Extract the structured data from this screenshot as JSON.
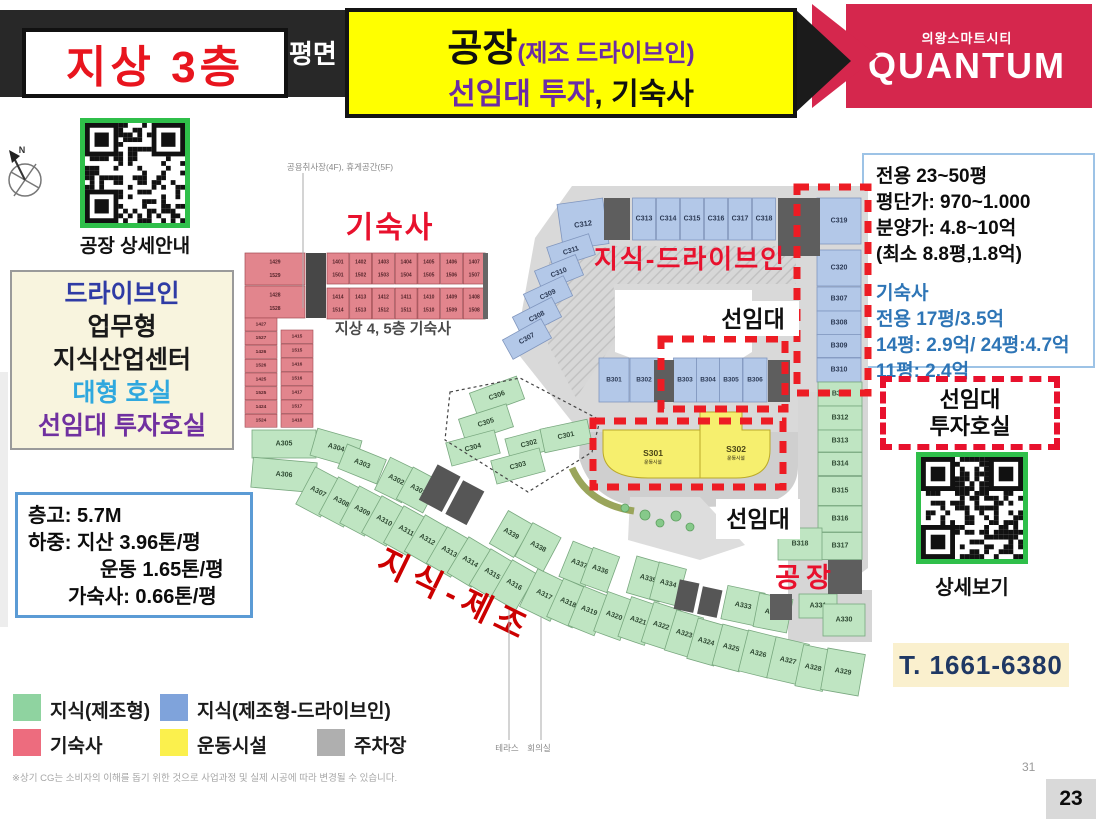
{
  "header": {
    "floor_badge": "지상 3층",
    "bar_partial_text": "평면",
    "banner_line1_main": "공장",
    "banner_line1_sub": "(제조 드라이브인)",
    "banner_line2_accent": "선임대 투자",
    "banner_line2_rest": ", 기숙사",
    "brand_city": "의왕스마트시티",
    "brand_name": "QUANTUM"
  },
  "qr_top": {
    "label": "공장 상세안내"
  },
  "feature_box": {
    "lines": [
      {
        "text": "드라이브인",
        "color": "#2F3BA5"
      },
      {
        "text": "업무형",
        "color": "#1A1A1A"
      },
      {
        "text": "지식산업센터",
        "color": "#1A1A1A"
      },
      {
        "text": "대형 호실",
        "color": "#2FA8DE"
      },
      {
        "text": "선임대 투자호실",
        "color": "#7030A0"
      }
    ]
  },
  "spec_box": {
    "lines": [
      "층고: 5.7M",
      "하중: 지산 3.96톤/평",
      "운동 1.65톤/평",
      "가숙사: 0.66톤/평"
    ]
  },
  "price_box": {
    "black_lines": [
      "전용 23~50평",
      "평단가: 970~1.000",
      "분양가: 4.8~10억",
      "(최소 8.8평,1.8억)"
    ],
    "blue_lines": [
      "기숙사",
      "전용 17평/3.5억",
      "14평: 2.9억/ 24평:4.7억",
      "11평: 2.4억"
    ]
  },
  "prelease_box": {
    "line1": "선임대",
    "line2": "투자호실",
    "qr_label": "상세보기"
  },
  "phone": "T. 1661-6380",
  "page": {
    "small": "31",
    "big": "23"
  },
  "legend": {
    "items": [
      {
        "label": "지식(제조형)",
        "color": "#8FD3A0"
      },
      {
        "label": "지식(제조형-드라이브인)",
        "color": "#7FA3DB"
      },
      {
        "label": "기숙사",
        "color": "#ED6C7E"
      },
      {
        "label": "운동시설",
        "color": "#FBF04D"
      },
      {
        "label": "주차장",
        "color": "#AFAFAF"
      }
    ]
  },
  "footnote": "※상기 CG는 소비자의 이해를 돕기 위한 것으로 사업과정 및 실제 시공에 따라 변경될 수 있습니다.",
  "plan": {
    "compass": "N",
    "callout_top": "공용취사장(4F), 휴게공간(5F)",
    "dorm_title": "기숙사",
    "dorm_caption": "지상 4, 5층 기숙사",
    "label_drive_in": "지식-드라이브인",
    "label_manufacture": "지식-제조",
    "label_factory": "공장",
    "label_prelease_1": "선임대",
    "label_prelease_2": "선임대",
    "label_terrace": "테라스",
    "label_meeting": "회의실",
    "colors": {
      "green": "#BFE5C2",
      "blue": "#B3C8E8",
      "pink": "#E2858D",
      "yellow": "#F6EF6E",
      "corridor": "#D9D9D9",
      "dash_red": "#ED1C24"
    },
    "rooms": {
      "blue_top": [
        "C313",
        "C314",
        "C315",
        "C316",
        "C317",
        "C318"
      ],
      "blue_corner": "C312",
      "blue_diag": [
        "C311",
        "C310",
        "C309",
        "C308",
        "C307"
      ],
      "blue_right": [
        "C319",
        "C320",
        "B307",
        "B308",
        "B309",
        "B310"
      ],
      "blue_center": [
        "B301",
        "B302",
        "B303",
        "B304",
        "B305",
        "B306"
      ],
      "green_cluster": [
        "C306",
        "C305",
        "C304",
        "C302",
        "C303",
        "C301"
      ],
      "green_right": [
        "B311",
        "B312",
        "B313",
        "B314",
        "B315",
        "B316",
        "B317"
      ],
      "green_right_extra": [
        "B319",
        "B318"
      ],
      "green_band_lower": [
        "A305",
        "A306",
        "A307",
        "A308",
        "A309",
        "A310",
        "A311",
        "A312",
        "A313",
        "A314",
        "A315",
        "A316",
        "A317",
        "A318",
        "A319",
        "A320",
        "A321",
        "A322",
        "A323",
        "A324",
        "A325",
        "A326",
        "A327",
        "A328",
        "A329"
      ],
      "green_band_upper": [
        "A304",
        "A303",
        "A302",
        "A301",
        "A339",
        "A338",
        "A337",
        "A336",
        "A335",
        "A334",
        "A333",
        "A332",
        "A331",
        "A330"
      ],
      "sports": [
        {
          "id": "S301",
          "sub": "운동시설"
        },
        {
          "id": "S302",
          "sub": "운동시설"
        }
      ],
      "dorm_row1_top": [
        "1401",
        "1402",
        "1403",
        "1404",
        "1405",
        "1406",
        "1407"
      ],
      "dorm_row1_bottom": [
        "1501",
        "1502",
        "1503",
        "1504",
        "1505",
        "1506",
        "1507"
      ],
      "dorm_row2_top": [
        "1414",
        "1413",
        "1412",
        "1411",
        "1410",
        "1409",
        "1408"
      ],
      "dorm_row2_bottom": [
        "1514",
        "1513",
        "1512",
        "1511",
        "1510",
        "1509",
        "1508"
      ],
      "dorm_corner": [
        [
          "1429",
          "1529"
        ],
        [
          "1428",
          "1528"
        ]
      ],
      "dorm_left_col": [
        "1427",
        "1527",
        "1426",
        "1526",
        "1425",
        "1525",
        "1424",
        "1524"
      ],
      "dorm_inner_col": [
        "1415",
        "1515",
        "1416",
        "1516",
        "1417",
        "1517",
        "1418"
      ]
    }
  }
}
